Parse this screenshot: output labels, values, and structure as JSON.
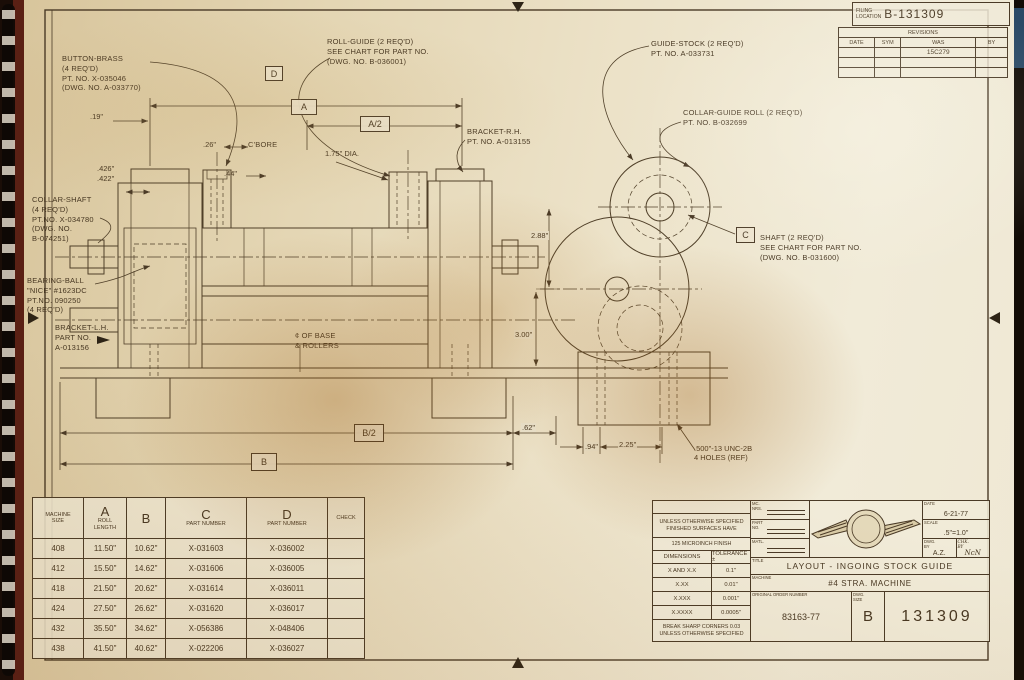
{
  "colors": {
    "paper": "#e9dfc2",
    "line": "#4a3a26",
    "shadow": "#9c5e14",
    "binding": "#5a2014"
  },
  "filing": {
    "label": "FILING\nLOCATION",
    "number": "B-131309"
  },
  "revisions": {
    "title": "REVISIONS",
    "columns": [
      "DATE",
      "SYM",
      "WAS",
      "BY"
    ],
    "rows": [
      [
        "",
        "",
        "15C279",
        ""
      ],
      [
        "",
        "",
        "",
        ""
      ],
      [
        "",
        "",
        "",
        ""
      ]
    ]
  },
  "callouts": {
    "button_brass": "BUTTON-BRASS\n(4 REQ'D)\nPT. NO. X-035046\n(DWG. NO. A-033770)",
    "roll_guide": "ROLL-GUIDE (2 REQ'D)\nSEE CHART FOR PART NO.\n(DWG. NO. B-036001)",
    "guide_stock": "GUIDE-STOCK (2 REQ'D)\nPT. NO. A-033731",
    "collar_guide_roll": "COLLAR-GUIDE ROLL (2 REQ'D)\nPT. NO. B-032699",
    "shaft": "SHAFT (2 REQ'D)\nSEE CHART FOR PART NO.\n(DWG. NO. B-031600)",
    "collar_shaft": "COLLAR-SHAFT\n(4 REQ'D)\nPT.NO. X-034780\n(DWG. NO.\nB-074251)",
    "bearing_ball": "BEARING-BALL\n\"NICE\" #1623DC\nPT.NO. 090250\n(4 REQ'D)",
    "bracket_lh": "BRACKET-L.H.\nPART NO.\nA-013156",
    "bracket_rh": "BRACKET-R.H.\nPT. NO. A-013155",
    "cbore": "C'BORE",
    "base_rollers": "¢ OF BASE\n& ROLLERS"
  },
  "dims": {
    "d19": ".19\"",
    "d26": ".26\"",
    "d44": ".44\"",
    "d426": ".426\"",
    "d422": ".422\"",
    "d175": "1.75\" DIA.",
    "d288": "2.88\"",
    "d300": "3.00\"",
    "d62": ".62\"",
    "d94": ".94\"",
    "d225": "2.25\"",
    "thread": ".500\"-13 UNC-2B\n4 HOLES (REF)"
  },
  "marks": {
    "a": "A",
    "a_half": "A/2",
    "b": "B",
    "b_half": "B/2",
    "c": "C",
    "d": "D"
  },
  "chart": {
    "headers": [
      {
        "small": "MACHINE\nSIZE"
      },
      {
        "big": "A",
        "small": "ROLL\nLENGTH"
      },
      {
        "big": "B"
      },
      {
        "big": "C",
        "small": "PART NUMBER"
      },
      {
        "big": "D",
        "small": "PART NUMBER"
      },
      {
        "small": "CHECK"
      }
    ],
    "rows": [
      [
        "408",
        "11.50\"",
        "10.62\"",
        "X-031603",
        "X-036002",
        ""
      ],
      [
        "412",
        "15.50\"",
        "14.62\"",
        "X-031606",
        "X-036005",
        ""
      ],
      [
        "418",
        "21.50\"",
        "20.62\"",
        "X-031614",
        "X-036011",
        ""
      ],
      [
        "424",
        "27.50\"",
        "26.62\"",
        "X-031620",
        "X-036017",
        ""
      ],
      [
        "432",
        "35.50\"",
        "34.62\"",
        "X-056386",
        "X-048406",
        ""
      ],
      [
        "438",
        "41.50\"",
        "40.62\"",
        "X-022206",
        "X-036027",
        ""
      ]
    ]
  },
  "title_block": {
    "spec_note": "UNLESS OTHERWISE SPECIFIED\nFINISHED SURFACES HAVE",
    "finish_note": "125 MICROINCH FINISH",
    "dim_col": "DIMENSIONS",
    "tol_col": "TOLERANCE ±",
    "tolerances": [
      [
        "X AND X.X",
        "0.1\""
      ],
      [
        "X.XX",
        "0.01\""
      ],
      [
        "X.XXX",
        "0.001\""
      ],
      [
        "X.XXXX",
        "0.0005\""
      ]
    ],
    "break_note": "BREAK SHARP CORNERS 0.03\nUNLESS OTHERWISE SPECIFIED",
    "field_mc": "MC.\nNRS.",
    "field_part": "PART\nNO.",
    "field_matl": "MATL.",
    "date_label": "DATE",
    "date": "6-21-77",
    "scale_label": "SCALE",
    "scale": ".5\"=1.0\"",
    "drawn_label": "DWG.\nBY",
    "drawn": "A.Z.",
    "checked_label": "CHK.\nBY",
    "checked": "NcN",
    "title_label": "TITLE",
    "title": "LAYOUT - INGOING STOCK GUIDE",
    "machine_label": "MACHINE",
    "machine": "#4 STRA. MACHINE",
    "order_label": "ORIGINAL ORDER NUMBER",
    "order": "83163-77",
    "size_label": "DWG.\nSIZE",
    "size": "B",
    "number": "131309"
  }
}
